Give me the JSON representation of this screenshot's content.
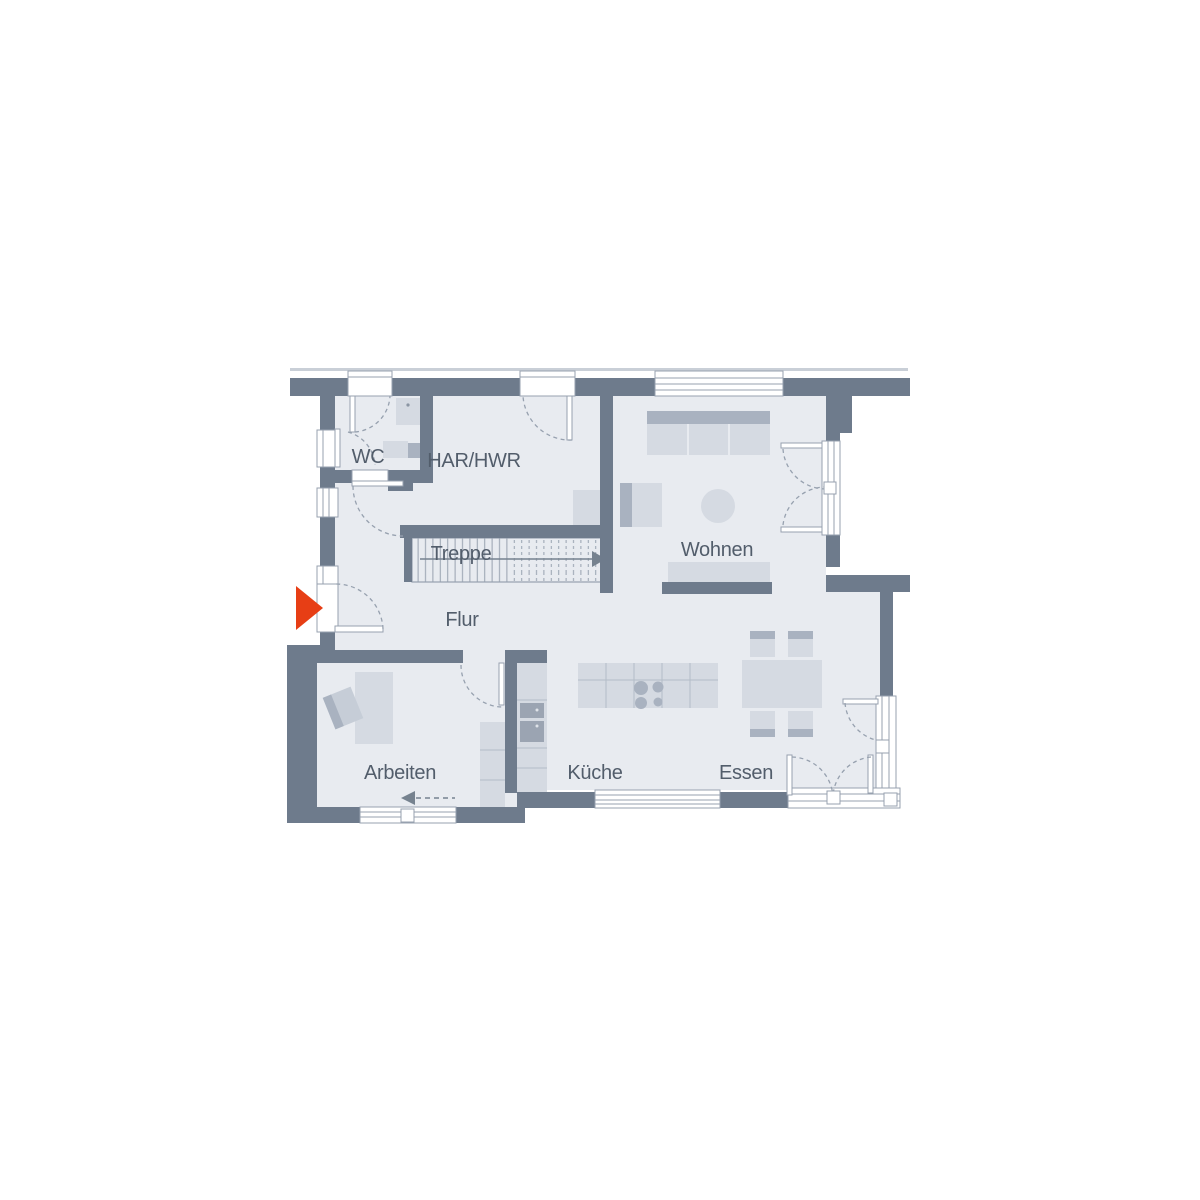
{
  "floorplan": {
    "rooms": {
      "wc": "WC",
      "har": "HAR/HWR",
      "treppe": "Treppe",
      "wohnen": "Wohnen",
      "flur": "Flur",
      "arbeiten": "Arbeiten",
      "kueche": "Küche",
      "essen": "Essen"
    },
    "markers": {
      "entrance_arrow": "entrance-direction-right",
      "stair_arrow": "stair-up-direction-right",
      "office_arrow": "direction-left"
    },
    "colors": {
      "wall": "#6e7b8c",
      "room": "#e8ebf0",
      "furn": "#d5dae2",
      "furn2": "#c6cdd7",
      "furndark": "#a9b2c0",
      "appliance": "#9ba4b2",
      "frame": "#97a1af",
      "outline": "#c9cfd7",
      "text": "#525d6b",
      "accent": "#e73e15"
    }
  }
}
